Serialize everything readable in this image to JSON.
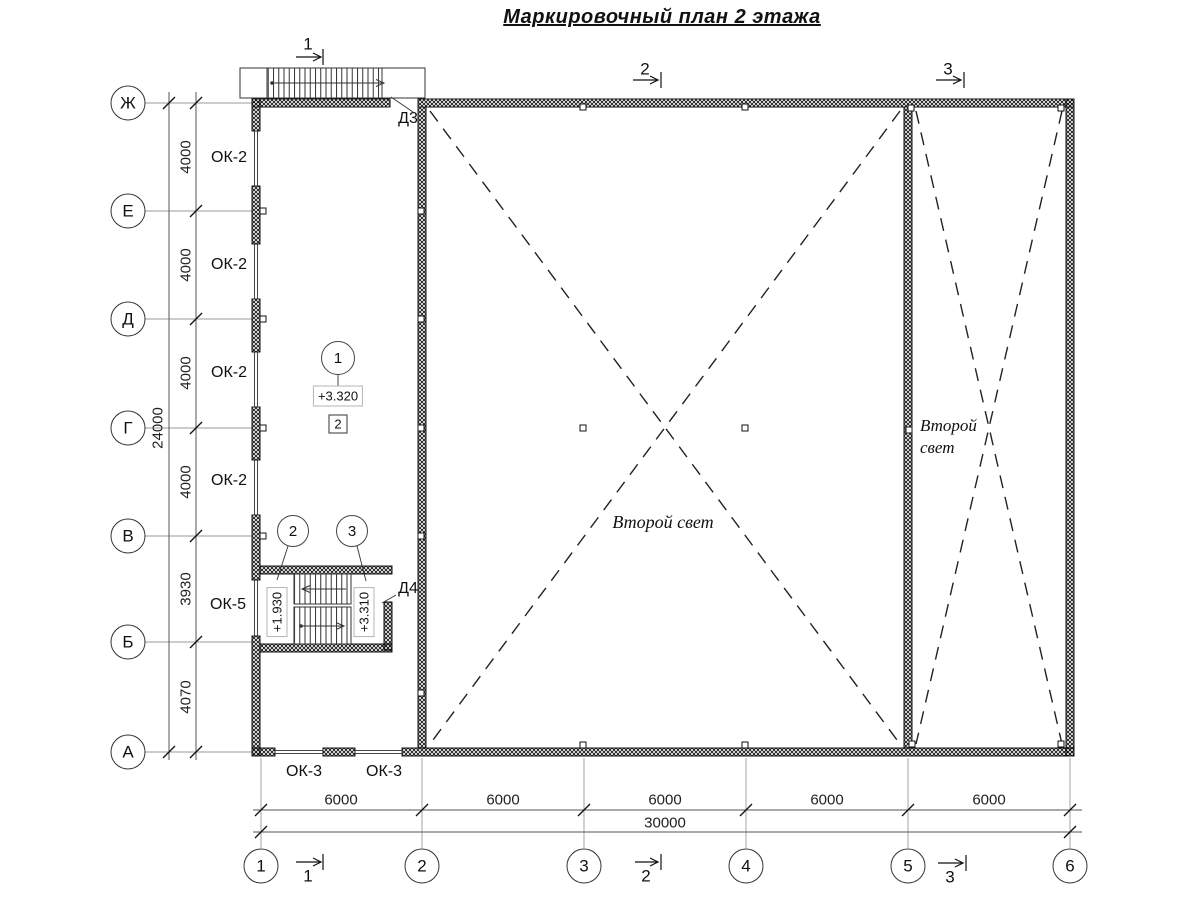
{
  "title": "Маркировочный план 2 этажа",
  "axes": {
    "rows": [
      "Ж",
      "Е",
      "Д",
      "Г",
      "В",
      "Б",
      "А"
    ],
    "cols": [
      "1",
      "2",
      "3",
      "4",
      "5",
      "6"
    ]
  },
  "dims": {
    "v": [
      "4000",
      "4000",
      "4000",
      "4000",
      "3930",
      "4070"
    ],
    "v_total": "24000",
    "h": [
      "6000",
      "6000",
      "6000",
      "6000",
      "6000"
    ],
    "h_total": "30000"
  },
  "windows": {
    "left": [
      "ОК-2",
      "ОК-2",
      "ОК-2",
      "ОК-2"
    ],
    "stair": "ОК-5",
    "bottom": [
      "ОК-3",
      "ОК-3"
    ]
  },
  "doors": {
    "d3": "Д3",
    "d4": "Д4"
  },
  "levels": {
    "floor": "+3.320",
    "stair_mid": "+1.930",
    "stair_upper": "+3.310"
  },
  "nodes": {
    "n1": "1",
    "n2": "2",
    "n3": "3",
    "boxed": "2"
  },
  "sections": {
    "s1": "1",
    "s2": "2",
    "s3": "3"
  },
  "labels": {
    "second_light": "Второй свет",
    "second_light_line1": "Второй",
    "second_light_line2": "свет"
  }
}
